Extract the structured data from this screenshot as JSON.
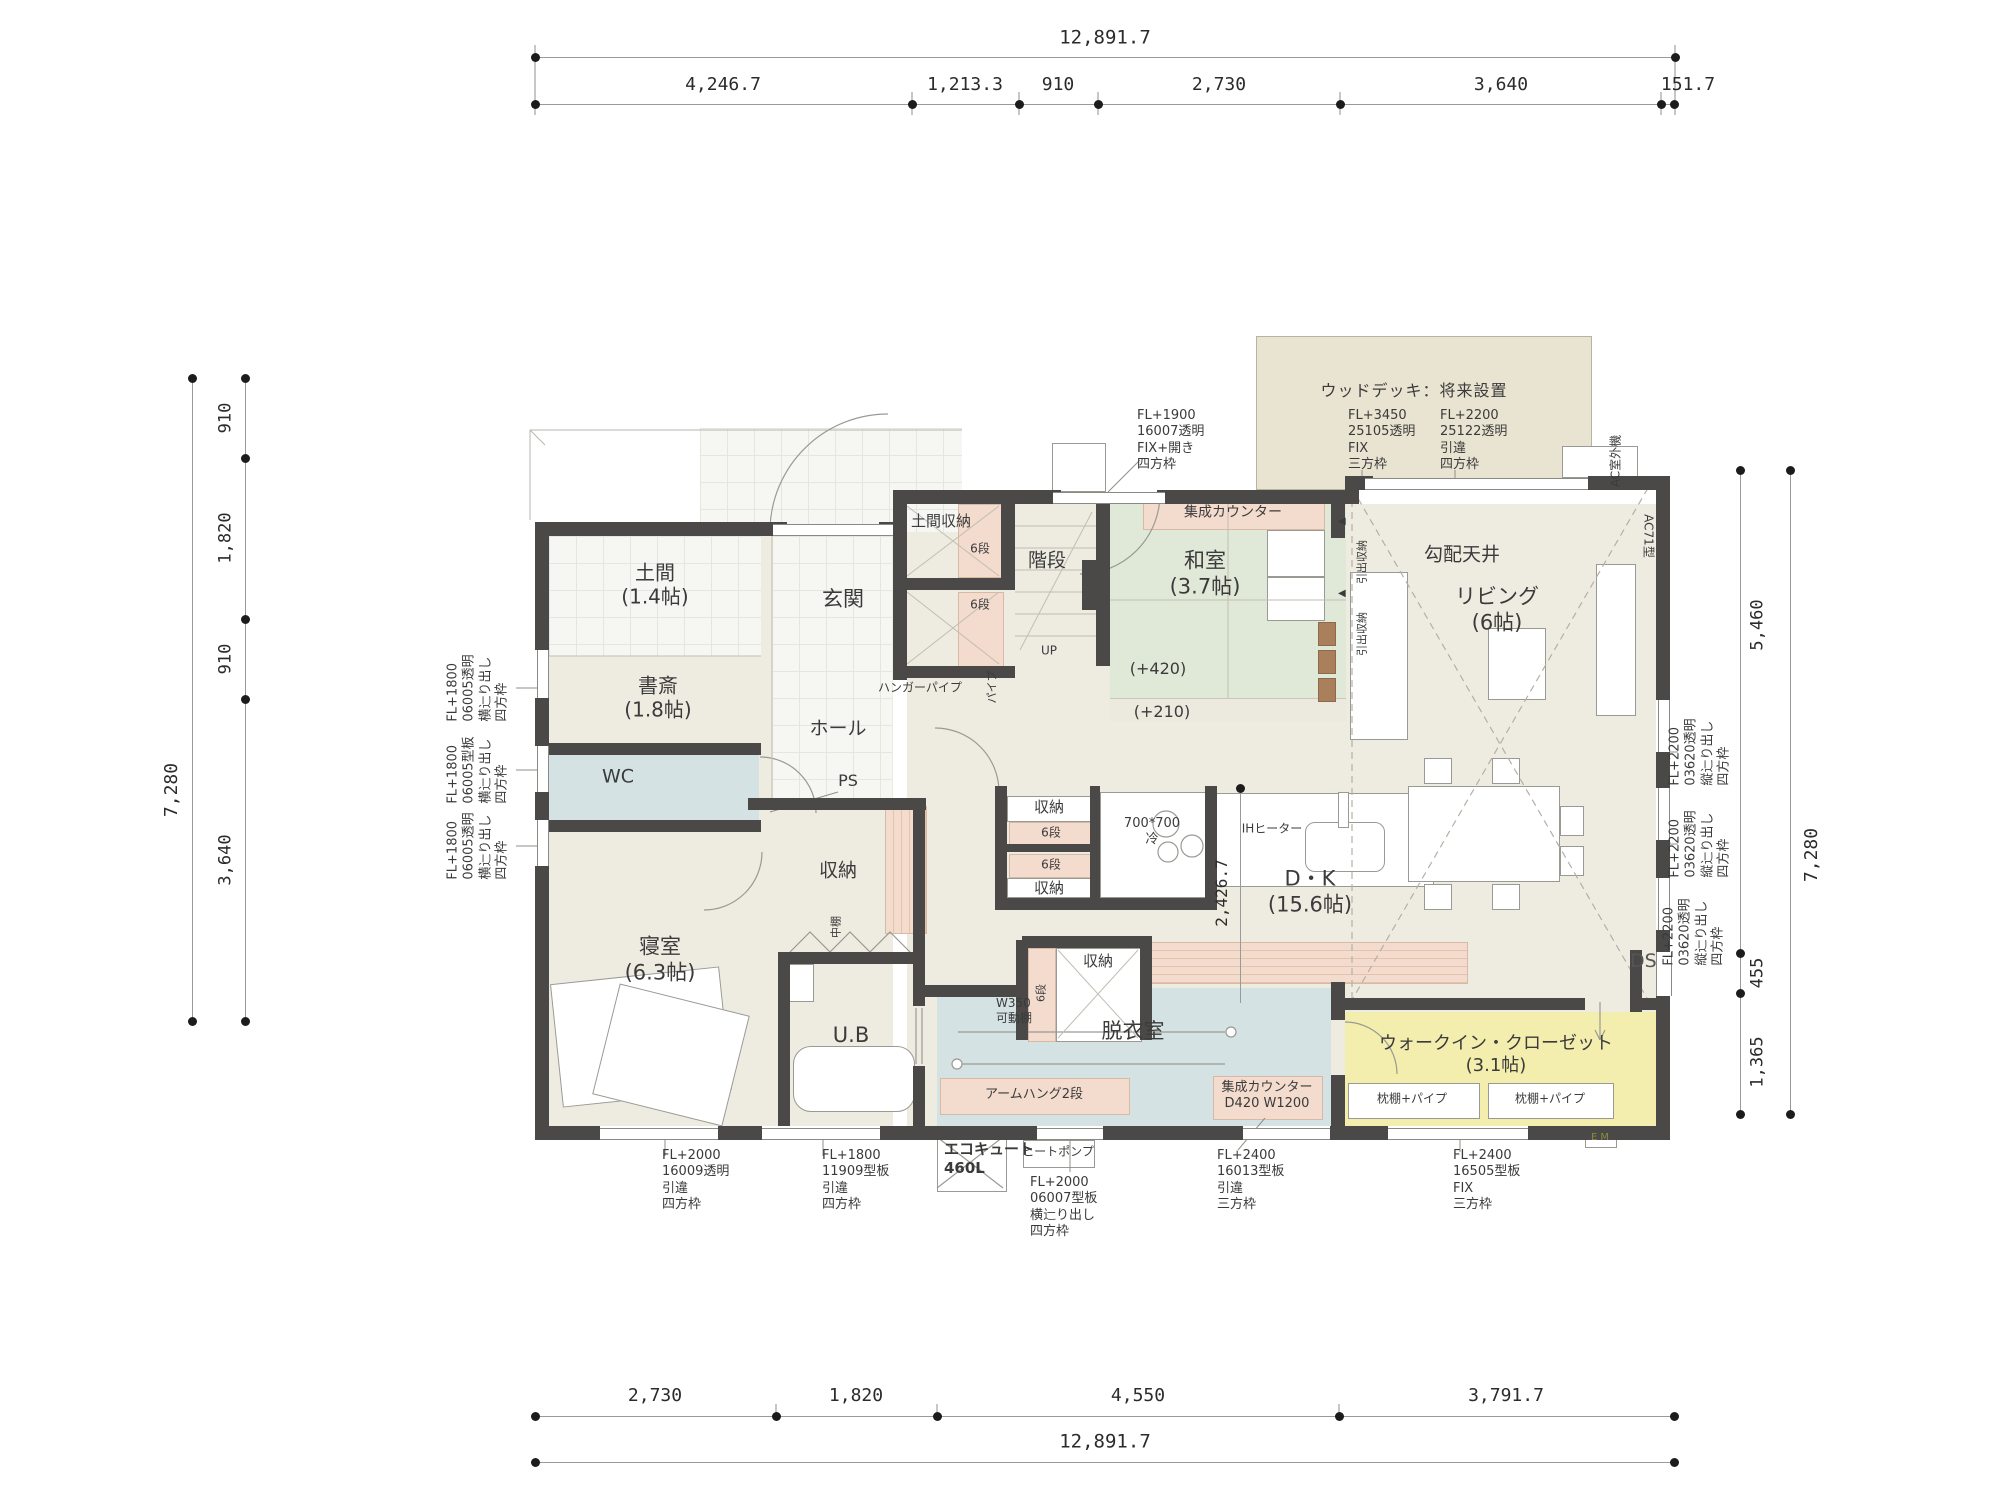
{
  "dims": {
    "top": {
      "total": "12,891.7",
      "s": [
        "4,246.7",
        "1,213.3",
        "910",
        "2,730",
        "3,640",
        "151.7"
      ]
    },
    "bottom": {
      "total": "12,891.7",
      "s": [
        "2,730",
        "1,820",
        "4,550",
        "3,791.7"
      ]
    },
    "left": {
      "total": "7,280",
      "s": [
        "910",
        "1,820",
        "910",
        "3,640"
      ]
    },
    "right": {
      "total": "7,280",
      "s": [
        "5,460",
        "455",
        "1,365"
      ]
    },
    "inner": "2,426.7"
  },
  "rooms": {
    "doma": {
      "name": "土間",
      "size": "(1.4帖)"
    },
    "shosai": {
      "name": "書斎",
      "size": "(1.8帖)"
    },
    "genkan": {
      "name": "玄関"
    },
    "doma_st": {
      "name": "土間収納"
    },
    "stairs": {
      "name": "階段",
      "up": "UP"
    },
    "washitsu": {
      "name": "和室",
      "size": "(3.7帖)",
      "lv1": "(+420)",
      "lv2": "(+210)"
    },
    "living": {
      "name": "リビング",
      "size": "(6帖)",
      "ceiling": "勾配天井"
    },
    "dk": {
      "name": "D・K",
      "size": "(15.6帖)"
    },
    "wc": {
      "name": "WC"
    },
    "hall": {
      "name": "ホール"
    },
    "bedroom": {
      "name": "寝室",
      "size": "(6.3帖)"
    },
    "ub": {
      "name": "U.B"
    },
    "datsui": {
      "name": "脱衣室"
    },
    "wic": {
      "name": "ウォークイン・クローゼット",
      "size": "(3.1帖)"
    }
  },
  "labels": {
    "rokudan": "6段",
    "shunou": "収納",
    "nakadana": "中棚",
    "hanger": "ハンガーパイプ",
    "pipe": "パイプ",
    "ps": "PS",
    "counter": "集成カウンター",
    "counter_spec": "D420  W1200",
    "hikidashi": "引出収納",
    "tri": "◀",
    "fridge1": "700*700",
    "fridge2": "冷",
    "ih": "IHヒーター",
    "w350a": "W350",
    "w350b": "可動棚",
    "armhang": "アームハング2段",
    "makura": "枕棚+パイプ",
    "em": "E M",
    "ds": "DS",
    "deck_title": "ウッドデッキ：将来設置",
    "ac_out": "AC室外機",
    "ac71": "AC71型",
    "eco1": "エコキュート",
    "eco2": "460L",
    "heatpump": "ヒートポンプ"
  },
  "ann": {
    "fix_open": [
      "FL+1900",
      "16007透明",
      "FIX+開き",
      "四方枠"
    ],
    "deck_fix": [
      "FL+3450",
      "25105透明",
      "FIX",
      "三方枠"
    ],
    "deck_slide": [
      "FL+2200",
      "25122透明",
      "引違",
      "四方枠"
    ],
    "left": [
      [
        "FL+1800",
        "06005透明",
        "横辷り出し",
        "四方枠"
      ],
      [
        "FL+1800",
        "06005型板",
        "横辷り出し",
        "四方枠"
      ],
      [
        "FL+1800",
        "06005透明",
        "横辷り出し",
        "四方枠"
      ]
    ],
    "right": [
      [
        "FL+2200",
        "03620透明",
        "縦辷り出し",
        "四方枠"
      ],
      [
        "FL+2200",
        "03620透明",
        "縦辷り出し",
        "四方枠"
      ],
      [
        "FL+2200",
        "03620透明",
        "縦辷り出し",
        "四方枠"
      ]
    ],
    "bottom": [
      [
        "FL+2000",
        "16009透明",
        "引違",
        "四方枠"
      ],
      [
        "FL+1800",
        "11909型板",
        "引違",
        "四方枠"
      ],
      [
        "FL+2000",
        "06007型板",
        "横辷り出し",
        "四方枠"
      ],
      [
        "FL+2400",
        "16013型板",
        "引違",
        "三方枠"
      ],
      [
        "FL+2400",
        "16505型板",
        "FIX",
        "三方枠"
      ]
    ]
  }
}
